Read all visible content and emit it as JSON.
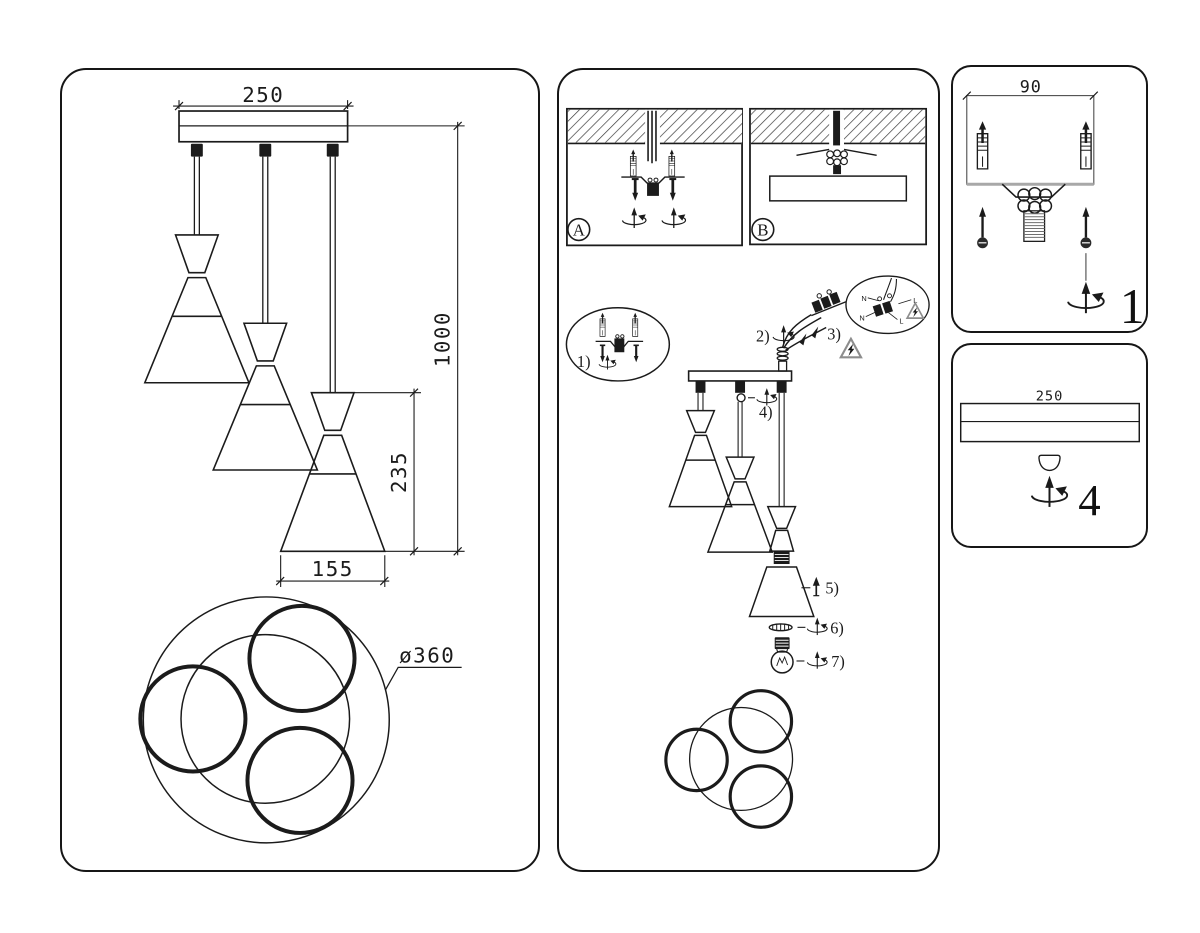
{
  "colors": {
    "ink": "#1b1b1b",
    "paper": "#ffffff",
    "warning_gray": "#8d8d8d",
    "plate_gray": "#a8a8a8"
  },
  "icons": {
    "rotate": "screw-rotation-arrow",
    "warning": "electric-shock-warning-triangle",
    "plug": "wall-anchor-plug",
    "screw": "mounting-screw",
    "bulb": "light-bulb",
    "hatch": "ceiling-section-hatch"
  },
  "left_panel": {
    "dim_canopy_width": "250",
    "dim_drop": "1000",
    "dim_shade_height": "235",
    "dim_shade_diameter": "155",
    "dim_footprint": "ø360"
  },
  "middle_panel": {
    "mount_a_label": "A",
    "mount_b_label": "B",
    "step1": "1)",
    "step2": "2)",
    "step3": "3)",
    "step4": "4)",
    "step5": "5)",
    "step6": "6)",
    "step7": "7)",
    "wire_n": "N",
    "wire_l": "L",
    "wire_n2": "N",
    "wire_l2": "L"
  },
  "detail1": {
    "dim_bracket_width": "90",
    "number": "1"
  },
  "detail4": {
    "dim_canopy_width": "250",
    "number": "4"
  }
}
